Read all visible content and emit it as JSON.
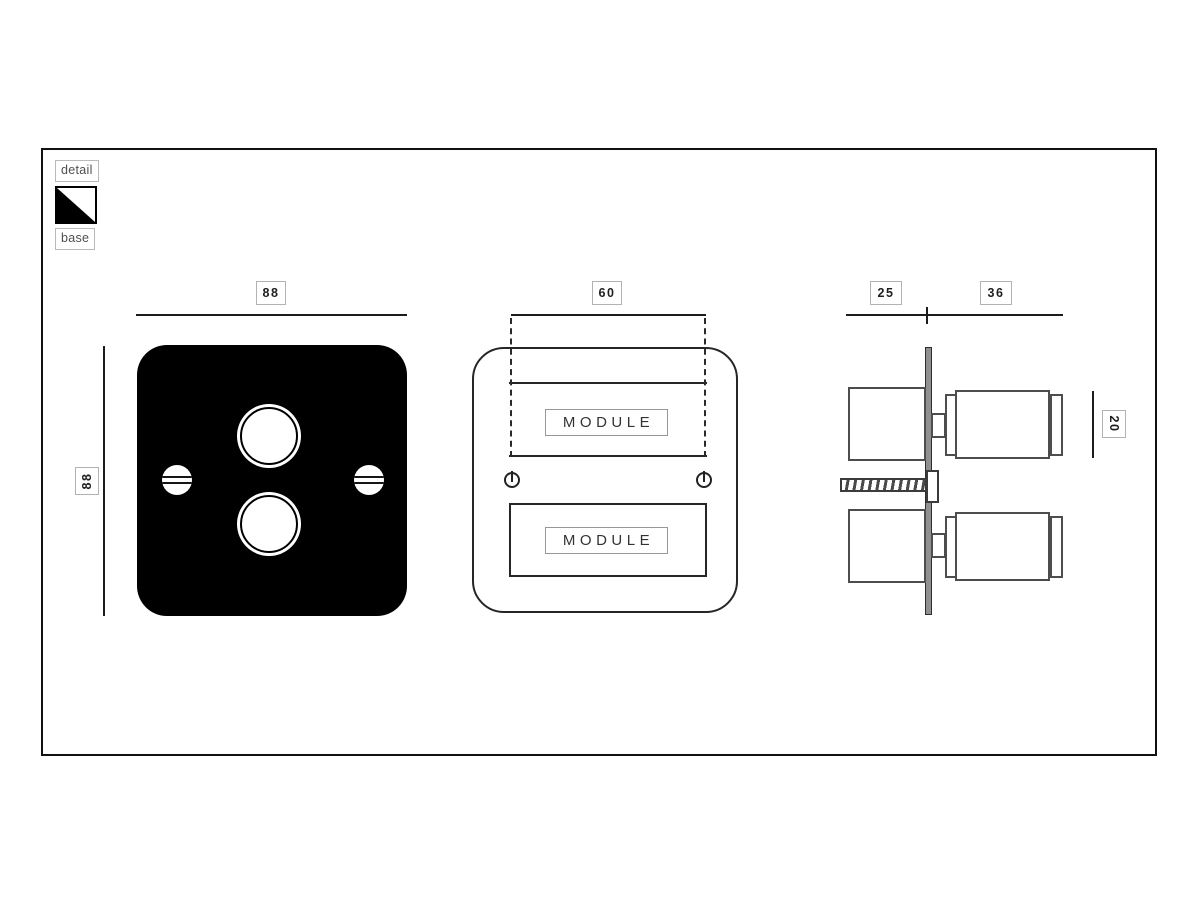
{
  "legend": {
    "detail_label": "detail",
    "base_label": "base",
    "swatch": "diagonal split square, black lower-left / white upper-right"
  },
  "front_view": {
    "width_dim": "88",
    "height_dim": "88"
  },
  "face_view": {
    "module_cutout_dim": "60",
    "modules": [
      "MODULE",
      "MODULE"
    ]
  },
  "side_view": {
    "back_depth_dim": "25",
    "front_depth_dim": "36",
    "knob_length_dim": "20"
  },
  "colors": {
    "plate_black": "#000000",
    "line_dark": "#1c1c1c",
    "side_line_gray": "#4d4d4d",
    "wall_plate_gray": "#909090",
    "label_border_gray": "#b2b2b2",
    "legend_text_gray": "#4f4f4f"
  }
}
